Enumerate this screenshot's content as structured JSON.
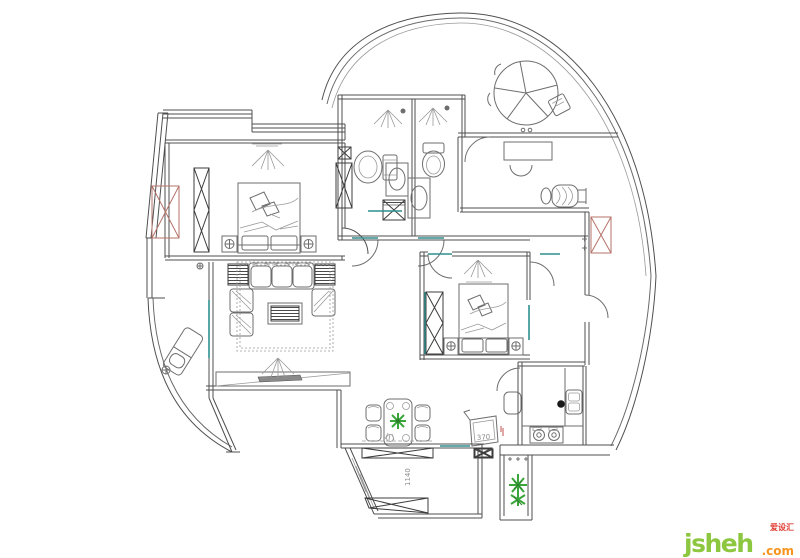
{
  "labels": {
    "box_width": "370",
    "balcony_depth": "1140"
  },
  "watermark": {
    "brand": "jsheh",
    "tld": ".com",
    "badge": "爱设汇",
    "brand_color": "#8dc63f",
    "tld_color": "#f7941d",
    "badge_color": "#e03c31"
  },
  "colors": {
    "wall_line": "#4f4f4f",
    "furniture_line": "#6e6e6e",
    "accent_teal": "#2e8f8f",
    "accent_red_x": "#b5736b",
    "plant_green": "#3aa63a",
    "background": "#ffffff"
  }
}
